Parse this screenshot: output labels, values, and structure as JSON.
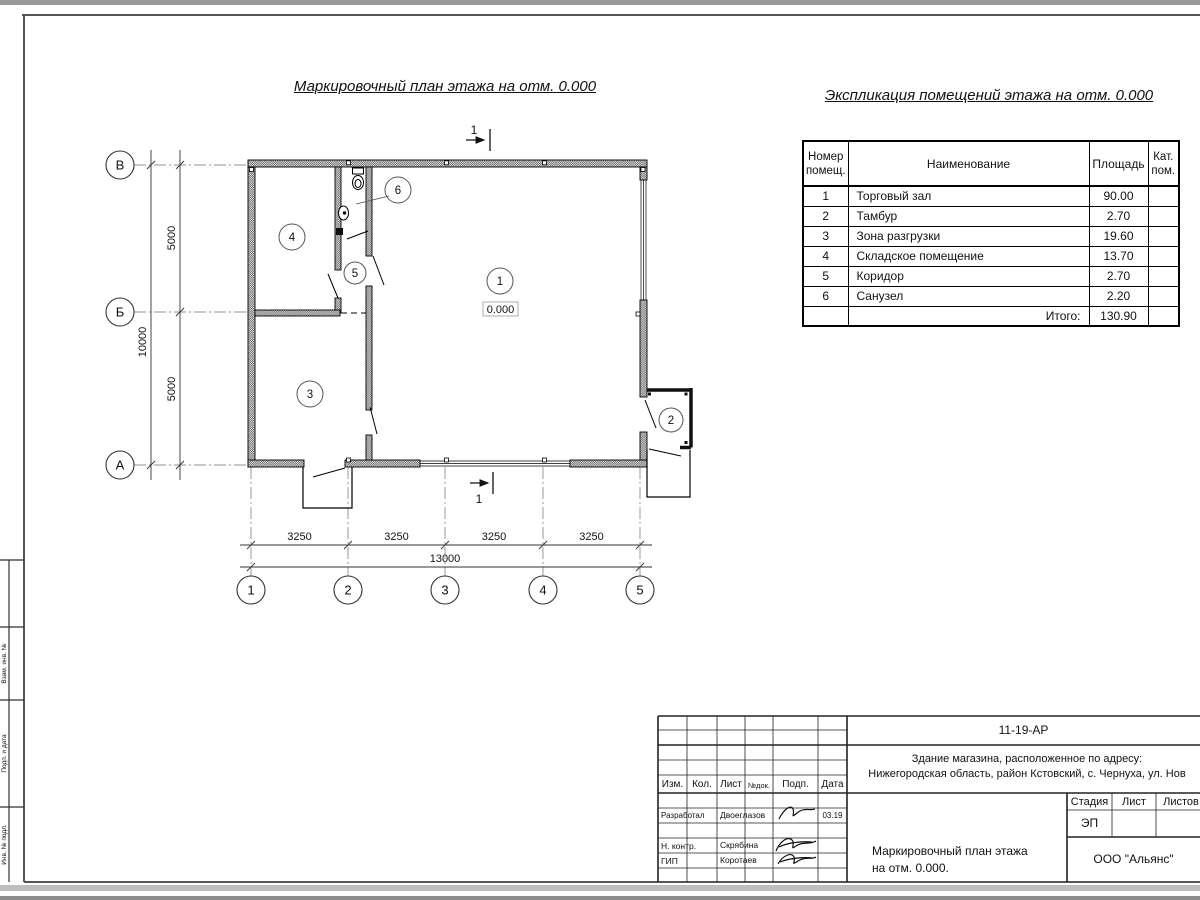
{
  "sheet": {
    "stamp_strip": [
      "Взам. инв. №",
      "Подп. и дата",
      "Инв. № подл."
    ]
  },
  "plan": {
    "title": "Маркировочный план этажа на отм. 0.000",
    "section_label": "1",
    "elevation": "0.000",
    "room_numbers": [
      "1",
      "2",
      "3",
      "4",
      "5",
      "6"
    ],
    "axes_letters": [
      "В",
      "Б",
      "А"
    ],
    "axes_numbers": [
      "1",
      "2",
      "3",
      "4",
      "5"
    ],
    "dims": {
      "left_segments": [
        "5000",
        "5000"
      ],
      "left_total": "10000",
      "bottom_segments": [
        "3250",
        "3250",
        "3250",
        "3250"
      ],
      "bottom_total": "13000"
    }
  },
  "explication": {
    "title": "Экспликация помещений этажа на отм. 0.000",
    "col_number_l1": "Номер",
    "col_number_l2": "помещ.",
    "col_name": "Наименование",
    "col_area": "Площадь",
    "col_cat_l1": "Кат.",
    "col_cat_l2": "пом.",
    "rows": [
      {
        "num": "1",
        "name": "Торговый зал",
        "area": "90.00"
      },
      {
        "num": "2",
        "name": "Тамбур",
        "area": "2.70"
      },
      {
        "num": "3",
        "name": "Зона разгрузки",
        "area": "19.60"
      },
      {
        "num": "4",
        "name": "Складское помещение",
        "area": "13.70"
      },
      {
        "num": "5",
        "name": "Коридор",
        "area": "2.70"
      },
      {
        "num": "6",
        "name": "Санузел",
        "area": "2.20"
      }
    ],
    "total_label": "Итого:",
    "total_area": "130.90"
  },
  "titleblock": {
    "doc_number": "11-19-АР",
    "object_line1": "Здание магазина, расположенное по адресу:",
    "object_line2": "Нижегородская область, район Кстовский, с. Чернуха, ул. Нов",
    "col_izm": "Изм.",
    "col_kol": "Кол.",
    "col_list": "Лист",
    "col_ndoc": "№док.",
    "col_podp": "Подп.",
    "col_data": "Дата",
    "stage_label": "Стадия",
    "sheet_label": "Лист",
    "sheets_label": "Листов",
    "stage_value": "ЭП",
    "drawing_title_l1": "Маркировочный план этажа",
    "drawing_title_l2": "на отм. 0.000.",
    "company": "ООО \"Альянс\"",
    "roles": [
      {
        "role": "Разработал",
        "name": "Двоеглазов",
        "date": "03.19"
      },
      {
        "role": "Н. контр.",
        "name": "Скрябина",
        "date": ""
      },
      {
        "role": "ГИП",
        "name": "Коротаев",
        "date": ""
      }
    ]
  }
}
